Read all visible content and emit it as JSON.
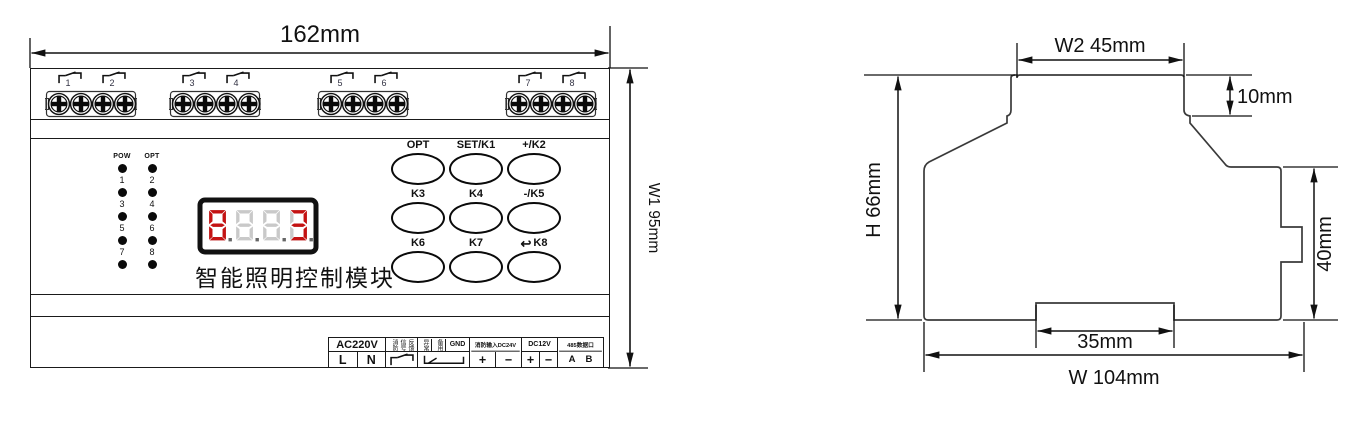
{
  "front_view": {
    "width_dim_label": "162mm",
    "height_dim_label": "W1  95mm",
    "terminal_channels": [
      "1",
      "2",
      "3",
      "4",
      "5",
      "6",
      "7",
      "8"
    ],
    "indicators": {
      "col1_header": "POW",
      "col2_header": "OPT",
      "col1_labels": [
        "1",
        "3",
        "5",
        "7"
      ],
      "col2_labels": [
        "2",
        "4",
        "6",
        "8"
      ]
    },
    "display": {
      "active_color": "#c41212",
      "inactive_color": "#c9c9c9",
      "digit_patterns": [
        "abcdefg",
        "",
        "",
        "abcdg"
      ]
    },
    "title": "智能照明控制模块",
    "buttons": [
      {
        "label": "OPT"
      },
      {
        "label": "SET/K1"
      },
      {
        "label": "+/K2"
      },
      {
        "label": "K3"
      },
      {
        "label": "K4"
      },
      {
        "label": "-/K5"
      },
      {
        "label": "K6"
      },
      {
        "label": "K7"
      },
      {
        "label": "K8",
        "icon": "↩"
      }
    ],
    "terminals": {
      "ac_header": "AC220V",
      "live": "L",
      "neutral": "N",
      "fire_feedback_cols": [
        "消防",
        "信号",
        "反馈"
      ],
      "abnormal": "异常",
      "spare": "备用",
      "gnd": "GND",
      "fire_input": "消防输入DC24V",
      "plus": "+",
      "minus": "−",
      "dc12v": "DC12V",
      "rs485": "485数据口",
      "a": "A",
      "b": "B"
    }
  },
  "side_view": {
    "dim_w2": "W2  45mm",
    "dim_step": "10mm",
    "dim_h": "H  66mm",
    "dim_clip": "40mm",
    "dim_notch": "35mm",
    "dim_w": "W   104mm"
  }
}
